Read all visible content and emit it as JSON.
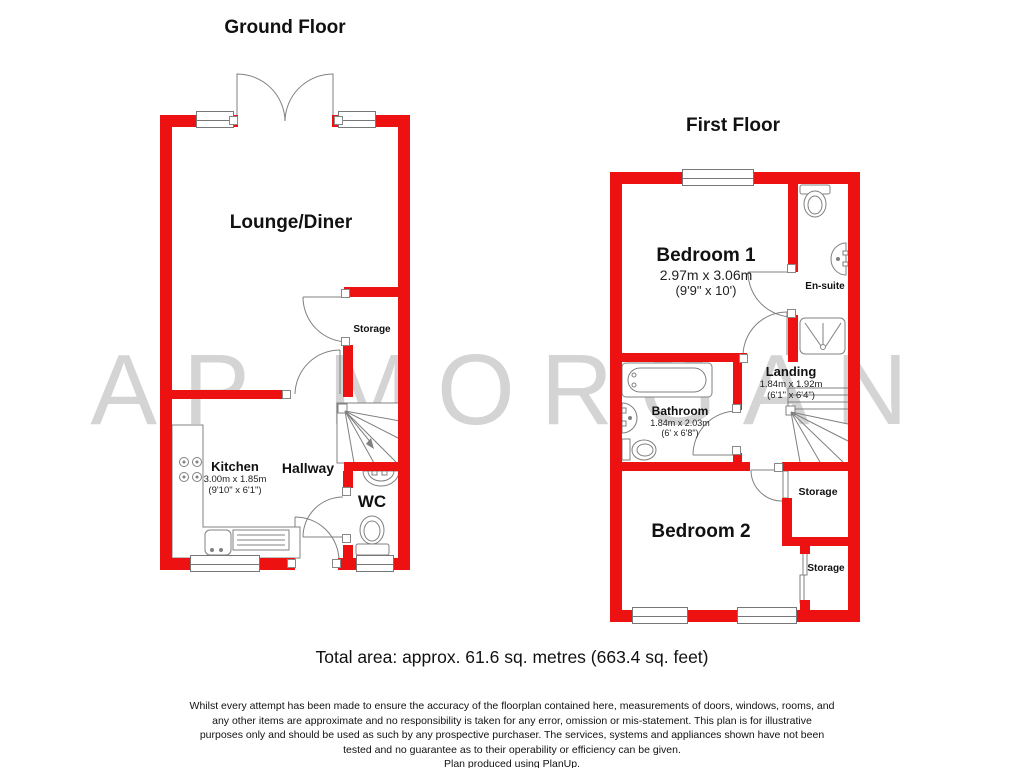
{
  "watermark": "AP MORGAN",
  "colors": {
    "wall_red": "#ee1111",
    "watermark_gray": "#d4d4d4",
    "line_gray": "#808080"
  },
  "ground_floor": {
    "title": "Ground Floor",
    "rooms": {
      "lounge": {
        "name": "Lounge/Diner"
      },
      "storage": {
        "name": "Storage"
      },
      "kitchen": {
        "name": "Kitchen",
        "size_metric": "3.00m x 1.85m",
        "size_imperial": "(9'10\" x 6'1\")"
      },
      "hallway": {
        "name": "Hallway"
      },
      "wc": {
        "name": "WC"
      }
    }
  },
  "first_floor": {
    "title": "First Floor",
    "rooms": {
      "bedroom1": {
        "name": "Bedroom 1",
        "size_metric": "2.97m x 3.06m",
        "size_imperial": "(9'9\" x 10')"
      },
      "ensuite": {
        "name": "En-suite"
      },
      "landing": {
        "name": "Landing",
        "size_metric": "1.84m x 1.92m",
        "size_imperial": "(6'1\" x 6'4\")"
      },
      "bathroom": {
        "name": "Bathroom",
        "size_metric": "1.84m x 2.03m",
        "size_imperial": "(6' x 6'8\")"
      },
      "bedroom2": {
        "name": "Bedroom 2"
      },
      "storage_upper": {
        "name": "Storage"
      },
      "storage_lower": {
        "name": "Storage"
      }
    }
  },
  "footer": {
    "total_area": "Total area: approx. 61.6 sq. metres (663.4 sq. feet)",
    "disclaimer_lines": [
      "Whilst every attempt has been made to ensure the accuracy of the floorplan contained here, measurements of doors, windows, rooms, and",
      "any other items are approximate and no responsibility is taken for any error, omission or mis-statement. This plan is for illustrative",
      "purposes only and should be used as such by any prospective purchaser. The services, systems and appliances shown have not been",
      "tested and no guarantee as to their operability or efficiency can be given.",
      "Plan produced using PlanUp."
    ]
  }
}
